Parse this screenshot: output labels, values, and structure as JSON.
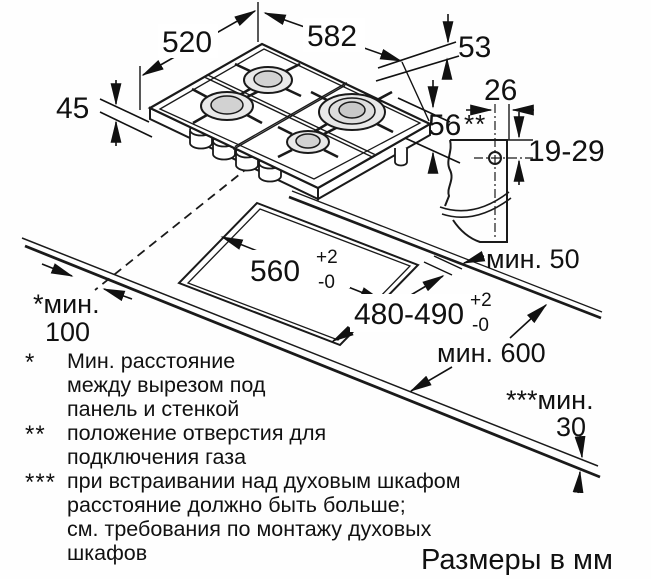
{
  "diagram": {
    "hob": {
      "depth_label": "520",
      "width_label": "582",
      "edge_height_label": "53",
      "front_height_label": "45",
      "body_height_label": "56"
    },
    "gas_connection": {
      "offset_label": "26",
      "marker": "**",
      "range_label": "19-29"
    },
    "cutout": {
      "width_label": "560",
      "width_tol_plus": "+2",
      "width_tol_minus": "-0",
      "depth_label": "480-490",
      "depth_tol_plus": "+2",
      "depth_tol_minus": "-0"
    },
    "clearances": {
      "rear_label": "мин. 50",
      "wall_marker": "*мин.",
      "wall_value": "100",
      "worktop_label": "мин. 600",
      "under_marker": "***мин.",
      "under_value": "30"
    },
    "footnotes": [
      {
        "marker": "*",
        "lines": [
          "Мин. расстояние",
          "между вырезом под",
          "панель и стенкой"
        ]
      },
      {
        "marker": "**",
        "lines": [
          "положение отверстия для",
          "подключения газа"
        ]
      },
      {
        "marker": "***",
        "lines": [
          "при встраивании над духовым шкафом",
          "расстояние должно быть больше;",
          "см. требования по монтажу духовых",
          "шкафов"
        ]
      }
    ],
    "units_note": "Размеры в мм"
  }
}
